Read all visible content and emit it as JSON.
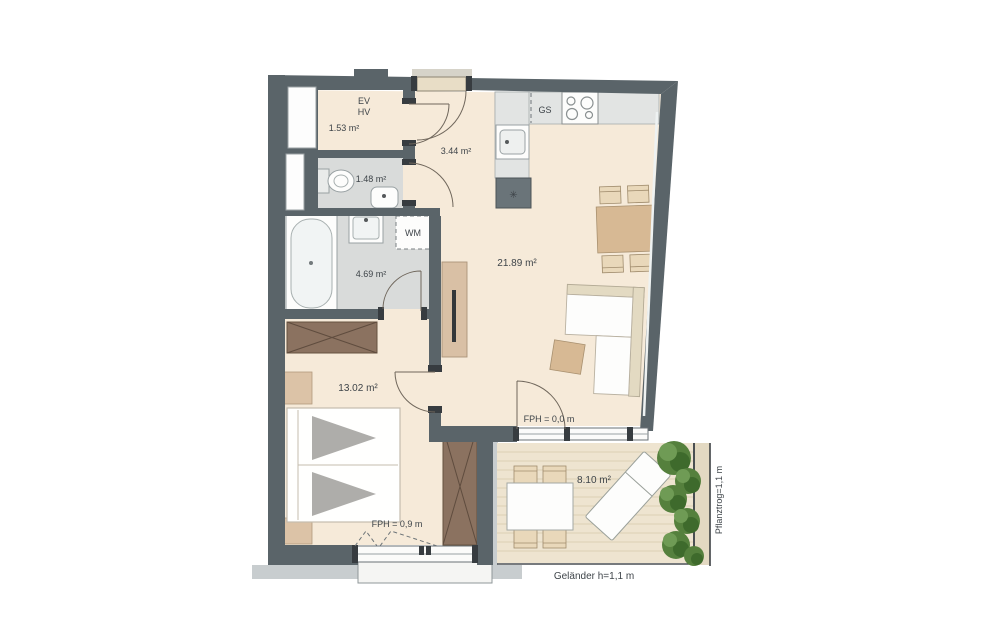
{
  "plan": {
    "type": "apartment-floor-plan",
    "labels": {
      "ev": "EV",
      "hv": "HV",
      "gs": "GS",
      "wm": "WM",
      "shaft_symbol": "✳",
      "area_utility": "1.53 m²",
      "area_wc": "1.48 m²",
      "area_hall": "3.44 m²",
      "area_bath": "4.69 m²",
      "area_living": "21.89 m²",
      "area_bedroom": "13.02 m²",
      "area_balcony": "8.10 m²",
      "fph_balcony": "FPH = 0,0 m",
      "fph_bedroom": "FPH = 0,9 m",
      "railing": "Geländer h=1,1 m",
      "planter": "Pflanztrog=1,1 m"
    },
    "colors": {
      "wall": "#5a6469",
      "floor_cream": "#f6ead9",
      "floor_gray": "#d9dbda",
      "counter_gray": "#e2e4e3",
      "furniture_tan": "#d7b994",
      "wardrobe_brown": "#8b7260",
      "deck": "#eee4d0",
      "plant_green": "#55803d",
      "exterior_band": "#c8cdcf",
      "text": "#3e4449"
    }
  }
}
